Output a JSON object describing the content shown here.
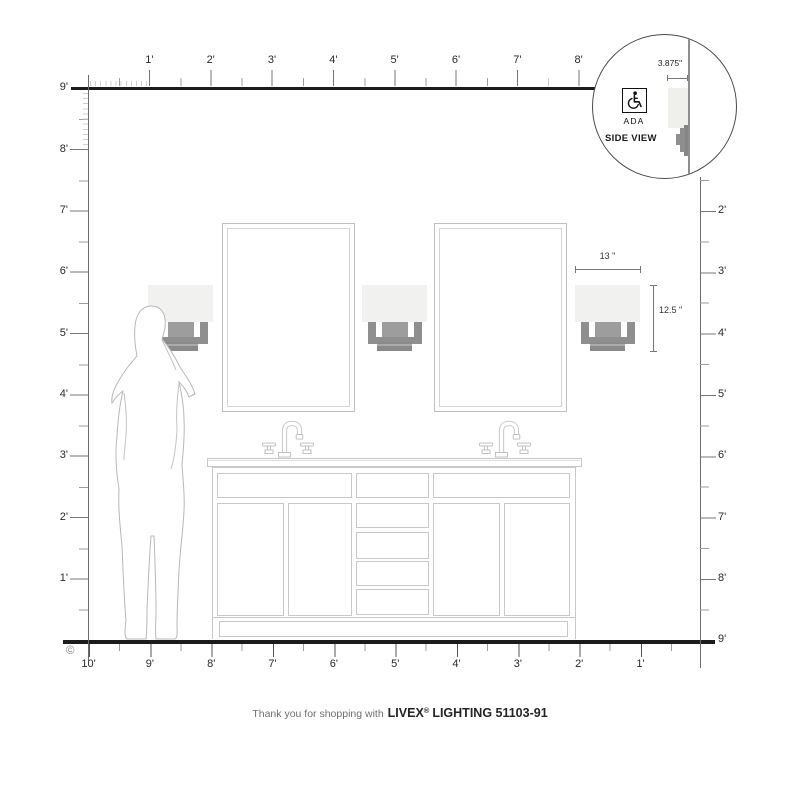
{
  "rulers": {
    "top_labels": [
      "1'",
      "2'",
      "3'",
      "4'",
      "5'",
      "6'",
      "7'",
      "8'"
    ],
    "left_labels": [
      "9'",
      "8'",
      "7'",
      "6'",
      "5'",
      "4'",
      "3'",
      "2'",
      "1'"
    ],
    "right_labels": [
      "2'",
      "3'",
      "4'",
      "5'",
      "6'",
      "7'",
      "8'",
      "9'"
    ],
    "bottom_labels": [
      "10'",
      "9'",
      "8'",
      "7'",
      "6'",
      "5'",
      "4'",
      "3'",
      "2'",
      "1'"
    ]
  },
  "inset": {
    "depth_dim": "3.875\"",
    "ada_label": "ADA",
    "side_view_label": "SIDE VIEW"
  },
  "fixture_dims": {
    "width": "13 \"",
    "height": "12.5 \""
  },
  "footer": {
    "thanks": "Thank you for shopping with",
    "brand": "LIVEX",
    "registered": "®",
    "product": "LIGHTING 51103-91"
  },
  "copyright_symbol": "©",
  "colors": {
    "frame_line": "#1c1c1c",
    "ruler_line": "#6b6b6b",
    "sconce_shade": "#f1f1ef",
    "sconce_metal": "#8f8f8f",
    "drawing_line": "#c9c9c9"
  }
}
